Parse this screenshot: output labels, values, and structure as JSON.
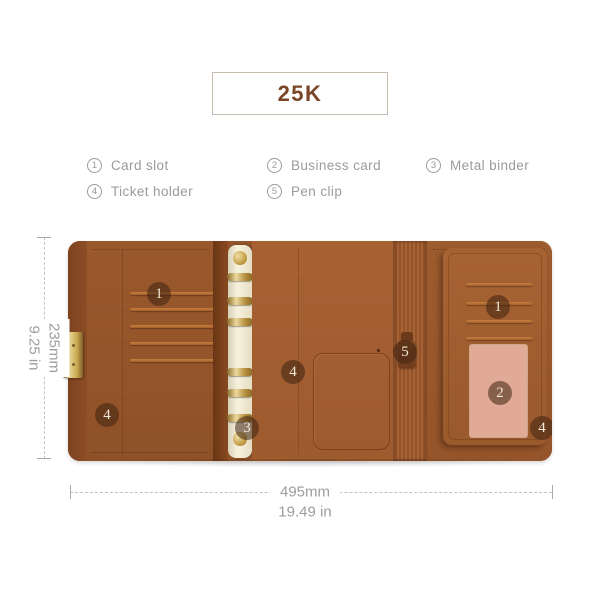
{
  "title": {
    "label": "25K"
  },
  "legend": {
    "items": [
      {
        "num": "1",
        "label": "Card slot"
      },
      {
        "num": "2",
        "label": "Business card"
      },
      {
        "num": "3",
        "label": "Metal binder"
      },
      {
        "num": "4",
        "label": "Ticket holder"
      },
      {
        "num": "5",
        "label": "Pen clip"
      }
    ]
  },
  "diagram": {
    "callouts": {
      "card_slot_left": "1",
      "card_slot_right": "1",
      "business_card": "2",
      "metal_binder": "3",
      "ticket_holder_left": "4",
      "ticket_holder_center": "4",
      "ticket_holder_right": "4",
      "pen_clip": "5"
    },
    "dimensions": {
      "height_mm": "235mm",
      "height_in": "9.25 in",
      "width_mm": "495mm",
      "width_in": "19.49 in"
    },
    "colors": {
      "leather_main": "#935429",
      "leather_center": "#a05c30",
      "leather_flap": "#a26030",
      "cover_edge": "#7c4320",
      "gold_hardware": "#c9a84f",
      "ring_strip": "#f3ecd6",
      "business_card_window": "#e0aa96",
      "badge_bg": "#3e2210",
      "title_text": "#7a4627",
      "annotation_gray": "#9b9b9b"
    }
  }
}
